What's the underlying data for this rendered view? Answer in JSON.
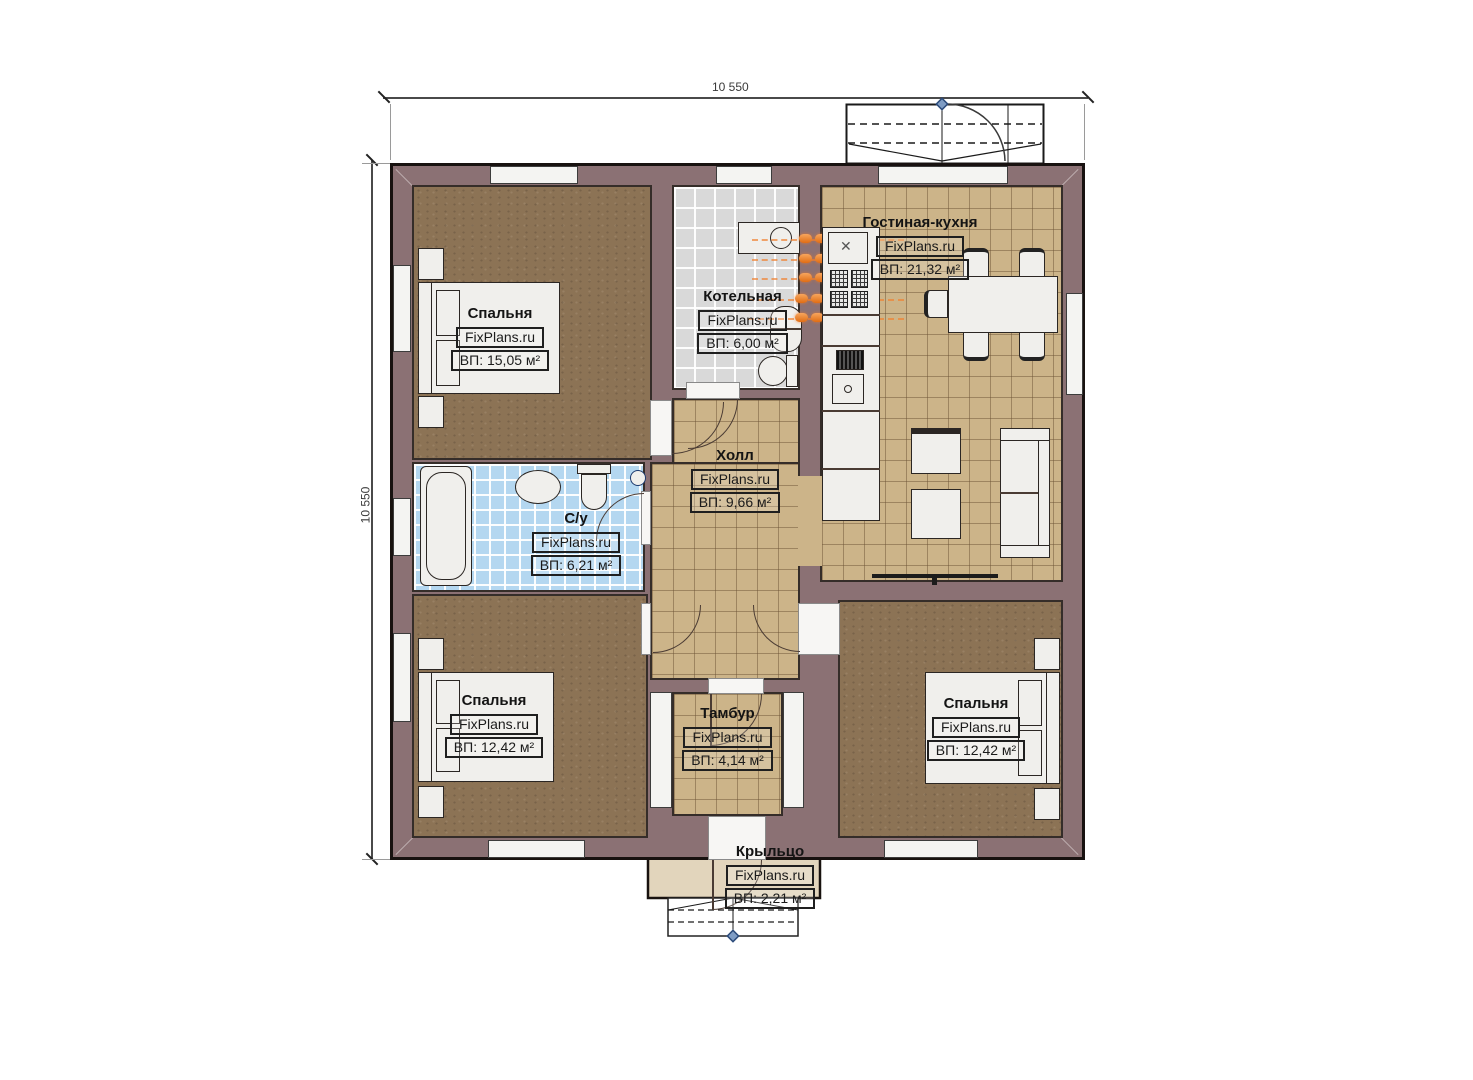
{
  "watermark": "FixPlans.ru",
  "dimensions": {
    "top": "10 550",
    "left": "10 550"
  },
  "rooms": {
    "bedroom_tl": {
      "name": "Спальня",
      "area": "ВП: 15,05 м²"
    },
    "boiler": {
      "name": "Котельная",
      "area": "ВП: 6,00 м²"
    },
    "living_kitchen": {
      "name": "Гостиная-кухня",
      "area": "ВП: 21,32 м²"
    },
    "hall": {
      "name": "Холл",
      "area": "ВП: 9,66 м²"
    },
    "bathroom": {
      "name": "С/у",
      "area": "ВП: 6,21 м²"
    },
    "bedroom_bl": {
      "name": "Спальня",
      "area": "ВП: 12,42 м²"
    },
    "tambur": {
      "name": "Тамбур",
      "area": "ВП: 4,14 м²"
    },
    "bedroom_br": {
      "name": "Спальня",
      "area": "ВП: 12,42 м²"
    },
    "porch": {
      "name": "Крыльцо",
      "area": "ВП: 2,21 м²"
    }
  },
  "colors": {
    "wall": "#8b7174",
    "wood_floor": "#8c7355",
    "tile_tan": "#ccb489",
    "tile_gray": "#d9d9d9",
    "tile_blue": "#b4d7f0",
    "porch_floor": "#e2d5bc",
    "radiator_orange": "#e06d14",
    "furniture": "#f0efec",
    "marker_blue": "#2b4a7a"
  }
}
